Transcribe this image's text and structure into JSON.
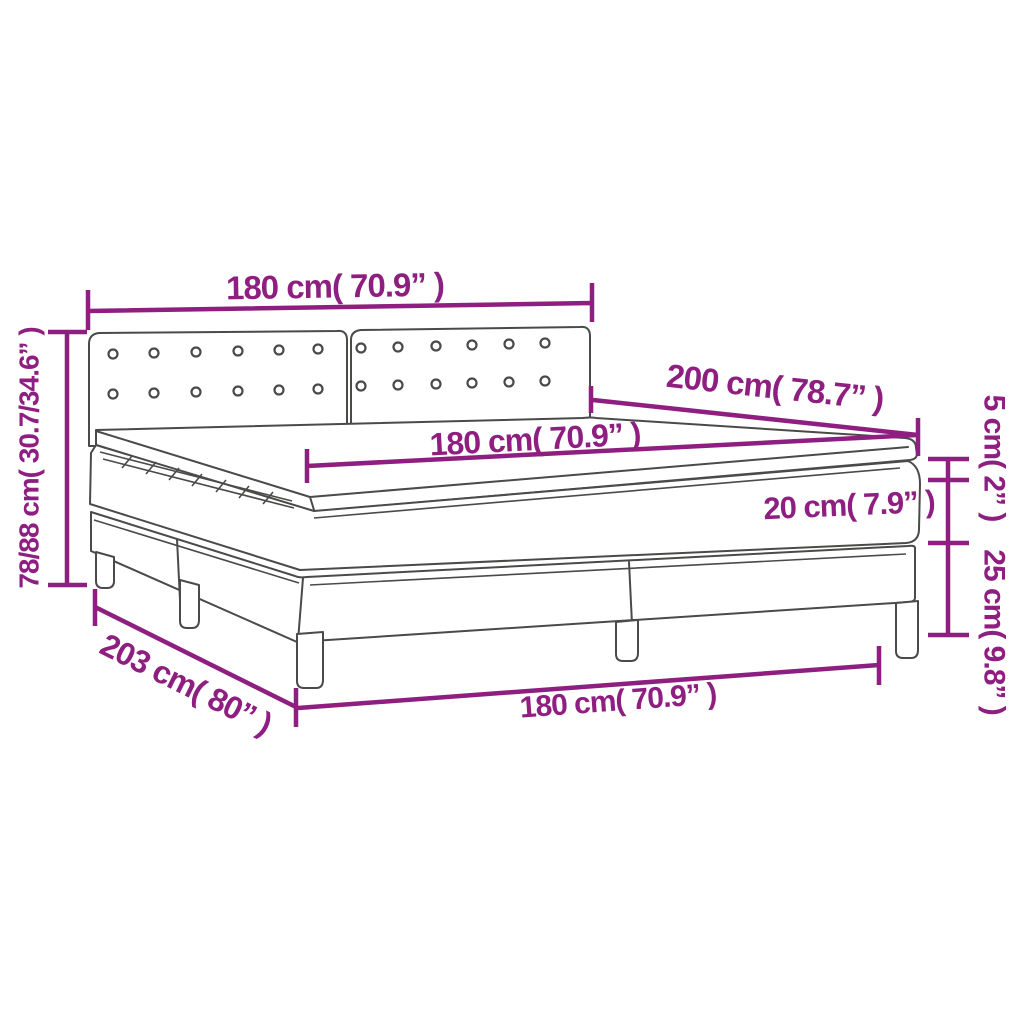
{
  "figure": {
    "kind": "product-dimension-diagram",
    "colors": {
      "dimension_annotation": "#8E1F80",
      "line_art": "#4A4A49",
      "background": "#FFFFFF"
    }
  },
  "dimensions": {
    "headboard_width": {
      "label": "180 cm( 70.9” )",
      "cm": "180",
      "inches": "70.9"
    },
    "total_height": {
      "label": "78/88 cm( 30.7/34.6” )",
      "cm": "78/88",
      "inches": "30.7/34.6"
    },
    "bed_depth": {
      "label": "200 cm( 78.7” )",
      "cm": "200",
      "inches": "78.7"
    },
    "mattress_width": {
      "label": "180 cm( 70.9” )",
      "cm": "180",
      "inches": "70.9"
    },
    "mattress_height": {
      "label": "20 cm( 7.9” )",
      "cm": "20",
      "inches": "7.9"
    },
    "topper_height": {
      "label": "5 cm( 2” )",
      "cm": "5",
      "inches": "2"
    },
    "base_height": {
      "label": "25 cm( 9.8” )",
      "cm": "25",
      "inches": "9.8"
    },
    "bed_length": {
      "label": "203 cm( 80” )",
      "cm": "203",
      "inches": "80"
    },
    "bed_width": {
      "label": "180 cm( 70.9” )",
      "cm": "180",
      "inches": "70.9"
    }
  }
}
